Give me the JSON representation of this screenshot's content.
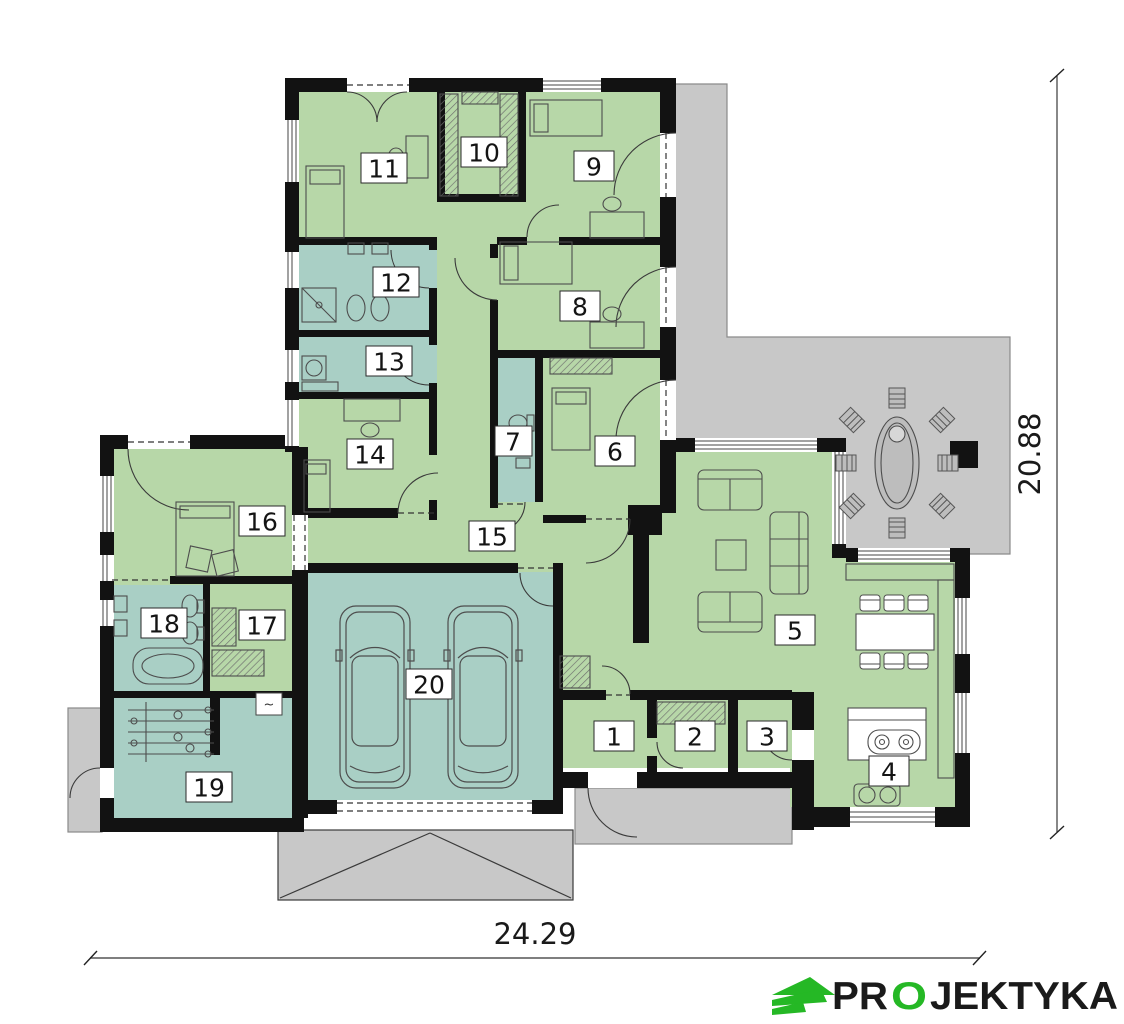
{
  "floor_plan": {
    "room_labels": [
      "1",
      "2",
      "3",
      "4",
      "5",
      "6",
      "7",
      "8",
      "9",
      "10",
      "11",
      "12",
      "13",
      "14",
      "15",
      "16",
      "17",
      "18",
      "19",
      "20"
    ],
    "dimensions": {
      "width_m": "24.29",
      "height_m": "20.88"
    },
    "symbols": {
      "water_heater": "~"
    },
    "colors": {
      "living_rooms": "#b7d7a8",
      "wet_rooms": "#a9cfc5",
      "terrace": "#c8c8c8",
      "walls": "#121212",
      "logo_green": "#25b825"
    }
  },
  "logo": {
    "prefix": "PR",
    "letter_o": "O",
    "suffix": "JEKTYKA"
  }
}
